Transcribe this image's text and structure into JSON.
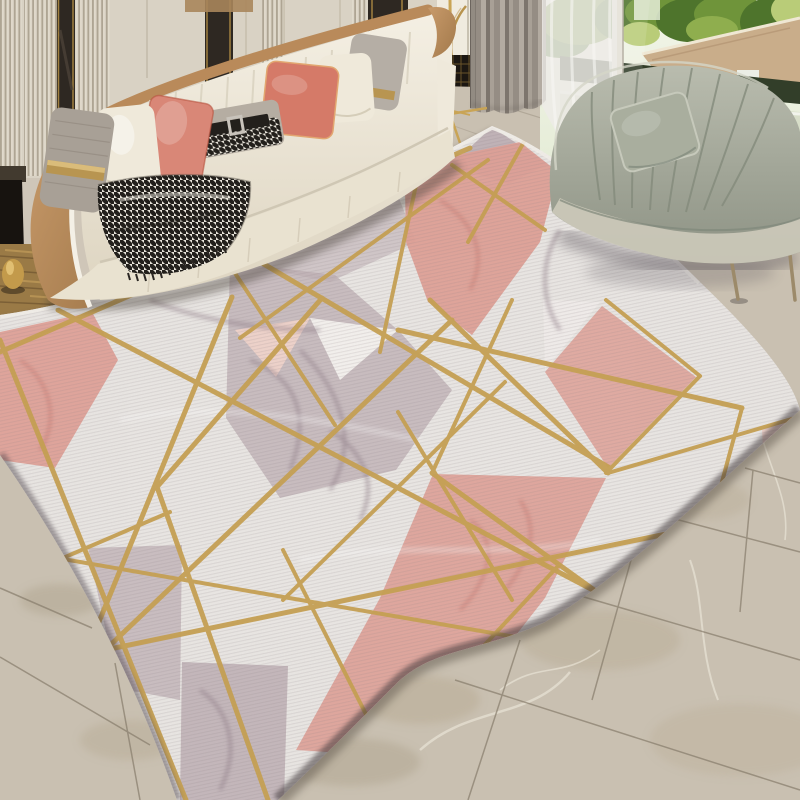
{
  "meta": {
    "type": "product-photograph",
    "subject": "geometric gold-line marble-print area rug styled in a modern living room",
    "canvas": "800x800"
  },
  "scene": {
    "room": "living room",
    "objects": [
      {
        "name": "fluted-wall-panels",
        "desc": "cream slatted wall paneling with dark mirror inlay strips"
      },
      {
        "name": "cream-sofa",
        "desc": "cream leather sofa with camel trim and white piping"
      },
      {
        "name": "pillows",
        "items": [
          "gray striped with metallic gold band",
          "cream",
          "coral velvet",
          "houndstooth lumbar with black belt buckle",
          "coral velvet",
          "cream",
          "gray striped with gold band"
        ]
      },
      {
        "name": "houndstooth-throw",
        "desc": "black and white houndstooth fringed throw draped on seat"
      },
      {
        "name": "gold-floor-lamp",
        "desc": "thin gold tripod floor lamp"
      },
      {
        "name": "gray-curtains",
        "desc": "gray lined drapes"
      },
      {
        "name": "sheer-curtain",
        "desc": "white voile sheer"
      },
      {
        "name": "window-view",
        "desc": "balcony railing, tan rooftop, green trees, hint of blue pool"
      },
      {
        "name": "sage-chaise",
        "desc": "sage green velvet channel-tufted chaise with matching pillow and thin metal legs"
      },
      {
        "name": "geometric-rug",
        "desc": "white, blush pink and mauve marble-print rug crossed by gold geometric lines"
      },
      {
        "name": "marble-tile-floor",
        "desc": "beige marble tiles with diagonal grout joints"
      },
      {
        "name": "wood-floor",
        "desc": "dark golden wood floor beside sofa with small gold vessel"
      }
    ]
  },
  "palette": {
    "wall_cream": "#ebe5d8",
    "mirror_dark": "#241f1b",
    "tan_trim": "#b98a5a",
    "sofa_cream": "#efe9db",
    "piping_white": "#f4f0e6",
    "pillow_gray": "#a8a096",
    "pillow_white": "#efe9da",
    "pillow_coral": "#d57a68",
    "lumbar_gray": "#b5ada2",
    "hound_dark": "#23201c",
    "gold_band": "#b89551",
    "sheer_white": "#edebe7",
    "foliage_dark": "#4e742c",
    "foliage_mid": "#6f943a",
    "foliage_light": "#b9cc78",
    "roof_tan": "#c9ad8a",
    "railing_dark": "#323e29",
    "terrace": "#d8dec9",
    "pool_blue": "#3f68a0",
    "chaise_pillow": "#a9ae9e",
    "chaise_leg": "#9c8a6a",
    "floor_beige": "#c9c0b1",
    "floor_grout": "#877c6b",
    "wood_brown": "#9a7a46",
    "rug_base": "#eae7e4",
    "rug_pink": "#dfa096",
    "rug_pink_light": "#efd3cb",
    "rug_mauve": "#bcadb2",
    "rug_vein": "#8f7b88",
    "vein_red": "#c4766d",
    "rug_gold": "#c6a052",
    "selvage": "#f2eee9",
    "edge_shadow": "#3f383b",
    "lamp_gold": "#c9a455"
  }
}
